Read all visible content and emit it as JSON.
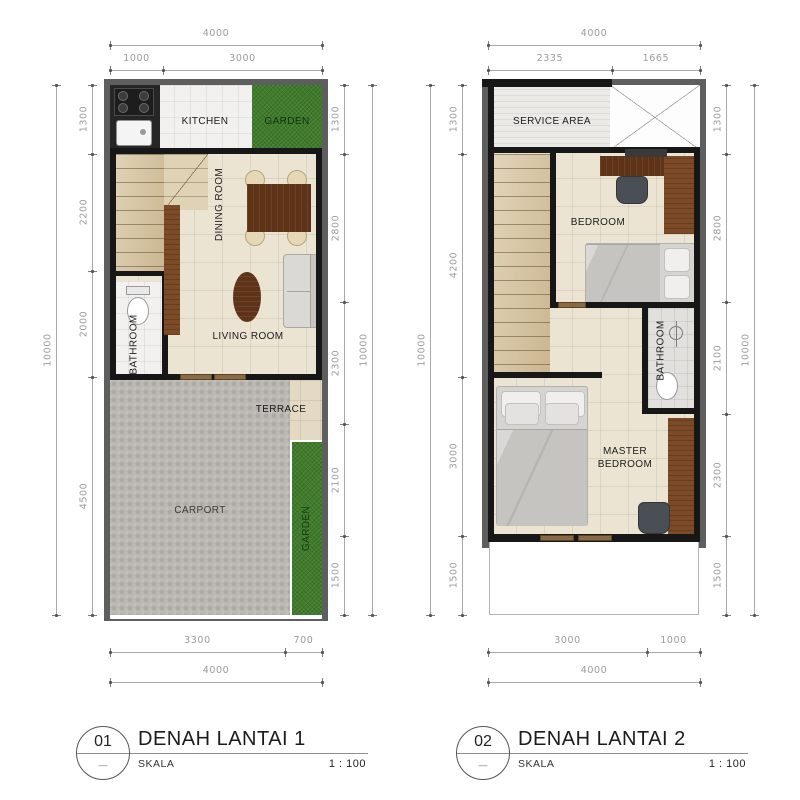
{
  "colors": {
    "outer_wall": "#5e5e5e",
    "inner_wall": "#171717",
    "grass_green": "#3f7d2b",
    "wood_dark": "#5f3317",
    "wood_light": "#7c4a27",
    "floor_cream": "#ece4d2",
    "stair_tan": "#d8c6a2",
    "paver_grey": "#bdbab5",
    "dim_text": "#9b9b9b"
  },
  "plans": [
    {
      "badge": "01",
      "badge_dash": "—",
      "title": "DENAH LANTAI 1",
      "scale_label": "SKALA",
      "scale_value": "1 : 100",
      "rooms": {
        "kitchen": "KITCHEN",
        "garden_top": "GARDEN",
        "dining": "DINING ROOM",
        "bathroom": "BATHROOM",
        "living": "LIVING ROOM",
        "terrace": "TERRACE",
        "carport": "CARPORT",
        "garden_side": "GARDEN"
      },
      "dims": {
        "top_total": "4000",
        "top_segments": [
          "1000",
          "3000"
        ],
        "left_total": "10000",
        "left_segments": [
          "1300",
          "2200",
          "2000",
          "4500"
        ],
        "right_total": "10000",
        "right_segments": [
          "1300",
          "2800",
          "2300",
          "2100",
          "1500"
        ],
        "bottom_segments": [
          "3300",
          "700"
        ],
        "bottom_total": "4000"
      }
    },
    {
      "badge": "02",
      "badge_dash": "—",
      "title": "DENAH LANTAI 2",
      "scale_label": "SKALA",
      "scale_value": "1 : 100",
      "rooms": {
        "service": "SERVICE AREA",
        "bedroom": "BEDROOM",
        "bathroom": "BATHROOM",
        "master": "MASTER BEDROOM"
      },
      "dims": {
        "top_total": "4000",
        "top_segments": [
          "2335",
          "1665"
        ],
        "left_total": "10000",
        "left_segments": [
          "1300",
          "4200",
          "3000",
          "1500"
        ],
        "right_total": "10000",
        "right_segments": [
          "1300",
          "2800",
          "2100",
          "2300",
          "1500"
        ],
        "bottom_segments": [
          "3000",
          "1000"
        ],
        "bottom_total": "4000"
      }
    }
  ]
}
